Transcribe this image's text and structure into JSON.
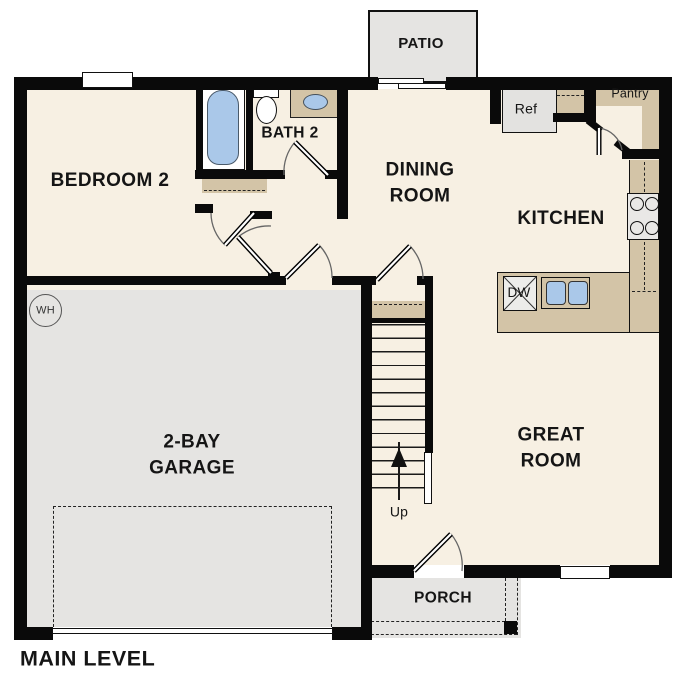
{
  "plan": {
    "title": "MAIN LEVEL",
    "labels": {
      "patio": "PATIO",
      "bedroom2": "BEDROOM 2",
      "bath2": "BATH 2",
      "dining1": "DINING",
      "dining2": "ROOM",
      "kitchen": "KITCHEN",
      "pantry": "Pantry",
      "ref": "Ref",
      "dw": "DW",
      "wh": "WH",
      "up": "Up",
      "great1": "GREAT",
      "great2": "ROOM",
      "garage1": "2-BAY",
      "garage2": "GARAGE",
      "porch": "PORCH"
    },
    "colors": {
      "floor": "#f7f0e3",
      "outdoor": "#e5e4e2",
      "counter": "#d3c4a7",
      "blue": "#aac8e9",
      "wall": "#0a0a0a",
      "appliance": "#e9e8e6"
    }
  }
}
